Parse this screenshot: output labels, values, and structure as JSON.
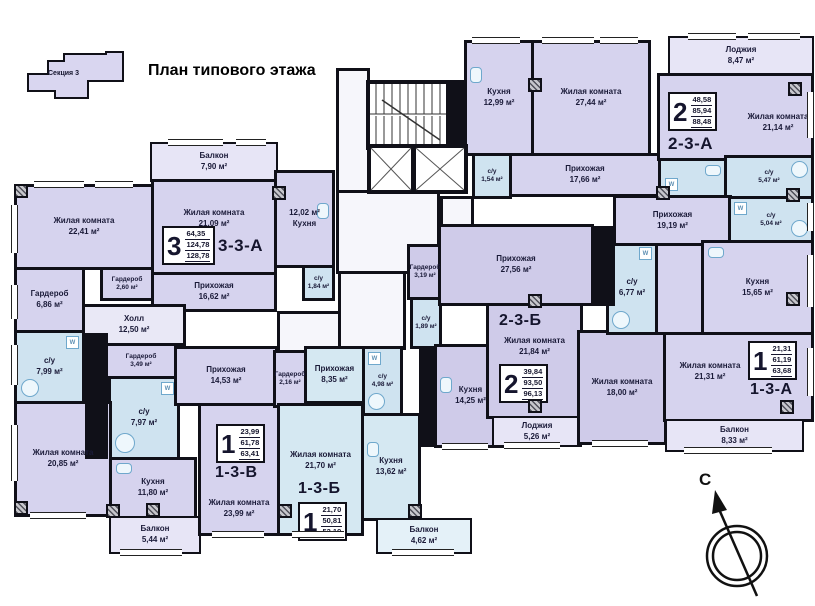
{
  "title": "План типового этажа",
  "key_plan": {
    "label": "Секция 3"
  },
  "compass": {
    "label": "С"
  },
  "fixtures": {
    "w_label": "W"
  },
  "apartments": {
    "a33a": {
      "code": "3-3-А",
      "num": "3",
      "a1": "64,35",
      "a2": "124,78",
      "a3": "128,78"
    },
    "a23a": {
      "code": "2-3-А",
      "num": "2",
      "a1": "48,58",
      "a2": "85,94",
      "a3": "88,48"
    },
    "a23b": {
      "code": "2-3-Б",
      "num": "2",
      "a1": "39,84",
      "a2": "93,50",
      "a3": "96,13"
    },
    "a13v": {
      "code": "1-3-В",
      "num": "1",
      "a1": "23,99",
      "a2": "61,78",
      "a3": "63,41"
    },
    "a13b": {
      "code": "1-3-Б",
      "num": "1",
      "a1": "21,70",
      "a2": "50,81",
      "a3": "52,19"
    },
    "a13a": {
      "code": "1-3-А",
      "num": "1",
      "a1": "21,31",
      "a2": "61,19",
      "a3": "63,68"
    }
  },
  "rooms": {
    "balcony_790": {
      "label": "Балкон",
      "area": "7,90 м²"
    },
    "living_2241": {
      "label": "Жилая комната",
      "area": "22,41 м²"
    },
    "living_2109": {
      "label": "Жилая комната",
      "area": "21,09 м²"
    },
    "kitchen_1202": {
      "label": "12,02 м²",
      "area": "Кухня"
    },
    "su_184": {
      "label": "с/у",
      "area": "1,84 м²"
    },
    "wardrobe_686": {
      "label": "Гардероб",
      "area": "6,86 м²"
    },
    "wardrobe_260": {
      "label": "Гардероб",
      "area": "2,60 м²"
    },
    "hallway_1662": {
      "label": "Прихожая",
      "area": "16,62 м²"
    },
    "hall_1250": {
      "label": "Холл",
      "area": "12,50 м²"
    },
    "su_799": {
      "label": "с/у",
      "area": "7,99 м²"
    },
    "wardrobe_349": {
      "label": "Гардероб",
      "area": "3,49 м²"
    },
    "su_797": {
      "label": "с/у",
      "area": "7,97 м²"
    },
    "living_2085": {
      "label": "Жилая комната",
      "area": "20,85 м²"
    },
    "kitchen_1180": {
      "label": "Кухня",
      "area": "11,80 м²"
    },
    "balcony_544": {
      "label": "Балкон",
      "area": "5,44 м²"
    },
    "hallway_1453": {
      "label": "Прихожая",
      "area": "14,53 м²"
    },
    "living_2399": {
      "label": "Жилая комната",
      "area": "23,99 м²"
    },
    "wardrobe_216": {
      "label": "Гардероб",
      "area": "2,16 м²"
    },
    "hallway_835": {
      "label": "Прихожая",
      "area": "8,35 м²"
    },
    "su_498": {
      "label": "с/у",
      "area": "4,98 м²"
    },
    "living_2170": {
      "label": "Жилая комната",
      "area": "21,70 м²"
    },
    "kitchen_1362": {
      "label": "Кухня",
      "area": "13,62 м²"
    },
    "balcony_462": {
      "label": "Балкон",
      "area": "4,62 м²"
    },
    "wardrobe_319": {
      "label": "Гардероб",
      "area": "3,19 м²"
    },
    "su_189": {
      "label": "с/у",
      "area": "1,89 м²"
    },
    "hallway_2756": {
      "label": "Прихожая",
      "area": "27,56 м²"
    },
    "kitchen_1425": {
      "label": "Кухня",
      "area": "14,25 м²"
    },
    "living_2184": {
      "label": "Жилая комната",
      "area": "21,84 м²"
    },
    "loggia_526": {
      "label": "Лоджия",
      "area": "5,26 м²"
    },
    "living_1800": {
      "label": "Жилая комната",
      "area": "18,00 м²"
    },
    "su_677": {
      "label": "с/у",
      "area": "6,77 м²"
    },
    "kitchen_1299": {
      "label": "Кухня",
      "area": "12,99 м²"
    },
    "living_2744": {
      "label": "Жилая комната",
      "area": "27,44 м²"
    },
    "su_154": {
      "label": "с/у",
      "area": "1,54 м²"
    },
    "hallway_1766": {
      "label": "Прихожая",
      "area": "17,66 м²"
    },
    "loggia_847": {
      "label": "Лоджия",
      "area": "8,47 м²"
    },
    "living_2114": {
      "label": "Жилая комната",
      "area": "21,14 м²"
    },
    "su_547": {
      "label": "с/у",
      "area": "5,47 м²"
    },
    "hallway_1919": {
      "label": "Прихожая",
      "area": "19,19 м²"
    },
    "su_504": {
      "label": "с/у",
      "area": "5,04 м²"
    },
    "kitchen_1565": {
      "label": "Кухня",
      "area": "15,65 м²"
    },
    "living_2131": {
      "label": "Жилая комната",
      "area": "21,31 м²"
    },
    "balcony_833": {
      "label": "Балкон",
      "area": "8,33 м²"
    }
  },
  "colors": {
    "wall": "#101018",
    "room": "#d6d3ee",
    "room_cyan": "#d5e8f2",
    "bath": "#cfe3f0",
    "corridor": "#f6f6fb"
  }
}
